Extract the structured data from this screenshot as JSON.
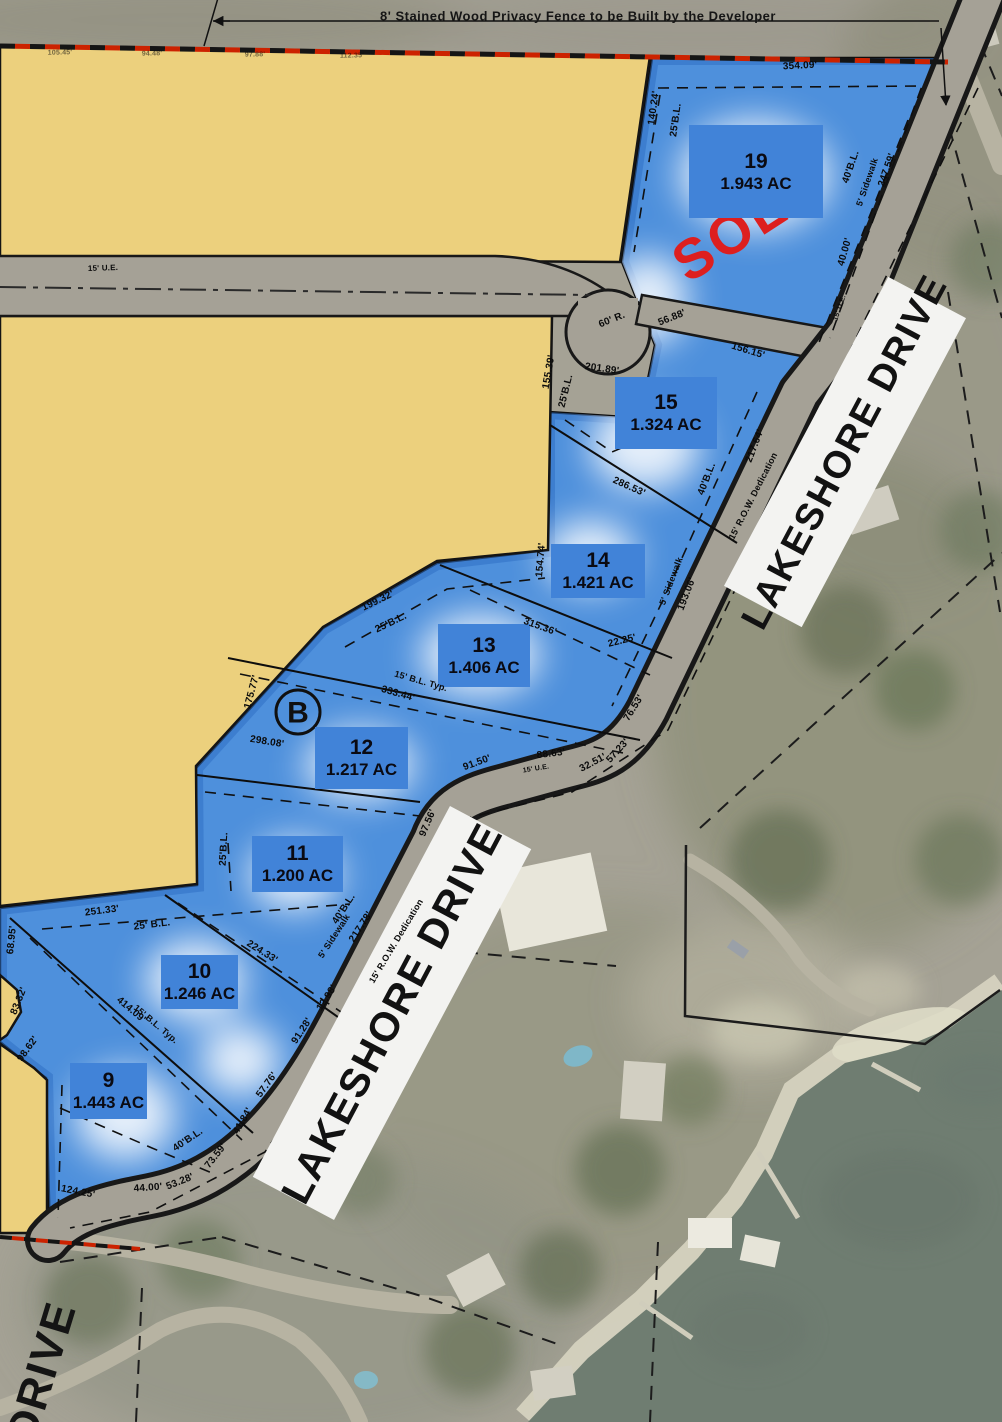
{
  "map_title": "Lakeshore Drive lakefront lot plat",
  "fence_note": "8' Stained Wood Privacy Fence to be Built by the Developer",
  "sold_stamp": "SOLD",
  "block_label": "B",
  "street_bands": [
    {
      "label": "LAKESHORE DRIVE"
    },
    {
      "label": "LAKESHORE DRIVE"
    }
  ],
  "partial_street_label": "DRIVE",
  "colors": {
    "lot_fill_blue": "#4e90dc",
    "lot_label_box_blue": "#4183d8",
    "parcel_yellow": "#ecd07d",
    "road_gray": "#a5a196",
    "sold_red": "#dd1f1f",
    "fence_dash_red": "#cc2200",
    "water_green": "#6f7d71",
    "band_white": "#f3f3f1"
  },
  "lots": [
    {
      "number": "19",
      "area": "1.943 AC",
      "sold": true,
      "x": 689,
      "y": 125,
      "w": 134,
      "h": 93
    },
    {
      "number": "15",
      "area": "1.324 AC",
      "sold": false,
      "x": 615,
      "y": 377,
      "w": 102,
      "h": 72
    },
    {
      "number": "14",
      "area": "1.421 AC",
      "sold": false,
      "x": 551,
      "y": 544,
      "w": 94,
      "h": 54
    },
    {
      "number": "13",
      "area": "1.406 AC",
      "sold": false,
      "x": 438,
      "y": 624,
      "w": 92,
      "h": 63
    },
    {
      "number": "12",
      "area": "1.217 AC",
      "sold": false,
      "x": 315,
      "y": 727,
      "w": 93,
      "h": 62
    },
    {
      "number": "11",
      "area": "1.200 AC",
      "sold": false,
      "x": 252,
      "y": 836,
      "w": 91,
      "h": 56
    },
    {
      "number": "10",
      "area": "1.246 AC",
      "sold": false,
      "x": 161,
      "y": 955,
      "w": 77,
      "h": 54
    },
    {
      "number": "9",
      "area": "1.443 AC",
      "sold": false,
      "x": 70,
      "y": 1063,
      "w": 77,
      "h": 56
    }
  ],
  "dimensions": [
    {
      "t": "354.09'",
      "x": 800,
      "y": 66,
      "r": -3
    },
    {
      "t": "140.24'",
      "x": 654,
      "y": 108,
      "r": -82
    },
    {
      "t": "25'B.L.",
      "x": 676,
      "y": 120,
      "r": -82
    },
    {
      "t": "40'B.L.",
      "x": 851,
      "y": 167,
      "r": -71
    },
    {
      "t": "5' Sidewalk",
      "x": 867,
      "y": 182,
      "r": -71,
      "s": 9
    },
    {
      "t": "247.59'",
      "x": 887,
      "y": 170,
      "r": -71
    },
    {
      "t": "40.00'",
      "x": 845,
      "y": 252,
      "r": -74
    },
    {
      "t": "15' U.E.",
      "x": 840,
      "y": 308,
      "r": -71,
      "s": 7
    },
    {
      "t": "56.88'",
      "x": 672,
      "y": 318,
      "r": -22
    },
    {
      "t": "60' R.",
      "x": 612,
      "y": 320,
      "r": -22
    },
    {
      "t": "201.89'",
      "x": 602,
      "y": 369,
      "r": 8
    },
    {
      "t": "155.39'",
      "x": 549,
      "y": 372,
      "r": -80
    },
    {
      "t": "25'B.L.",
      "x": 566,
      "y": 391,
      "r": -76
    },
    {
      "t": "156.15'",
      "x": 748,
      "y": 351,
      "r": 17
    },
    {
      "t": "217.64'",
      "x": 755,
      "y": 446,
      "r": -69
    },
    {
      "t": "40'B.L.",
      "x": 707,
      "y": 479,
      "r": -69
    },
    {
      "t": "286.53'",
      "x": 629,
      "y": 487,
      "r": 24
    },
    {
      "t": "154.74'",
      "x": 541,
      "y": 560,
      "r": -85
    },
    {
      "t": "15' R.O.W. Dedication",
      "x": 753,
      "y": 496,
      "r": -63,
      "s": 9
    },
    {
      "t": "5' Sidewalk",
      "x": 671,
      "y": 581,
      "r": -69,
      "s": 9
    },
    {
      "t": "193.06'",
      "x": 687,
      "y": 594,
      "r": -69
    },
    {
      "t": "315.36'",
      "x": 540,
      "y": 627,
      "r": 20
    },
    {
      "t": "22.25'",
      "x": 622,
      "y": 641,
      "r": -14
    },
    {
      "t": "199.32'",
      "x": 378,
      "y": 601,
      "r": -26
    },
    {
      "t": "25'B.L.",
      "x": 391,
      "y": 623,
      "r": -26
    },
    {
      "t": "15' B.L. Typ.",
      "x": 421,
      "y": 681,
      "r": 16,
      "s": 9
    },
    {
      "t": "333.44'",
      "x": 398,
      "y": 694,
      "r": 16
    },
    {
      "t": "175.77'",
      "x": 252,
      "y": 692,
      "r": -75
    },
    {
      "t": "76.53'",
      "x": 634,
      "y": 708,
      "r": -58
    },
    {
      "t": "57.23'",
      "x": 618,
      "y": 751,
      "r": -48
    },
    {
      "t": "32.51'",
      "x": 593,
      "y": 763,
      "r": -28
    },
    {
      "t": "88.63'",
      "x": 551,
      "y": 754,
      "r": -7
    },
    {
      "t": "15' U.E.",
      "x": 536,
      "y": 769,
      "r": -9,
      "s": 7
    },
    {
      "t": "91.50'",
      "x": 477,
      "y": 763,
      "r": -20
    },
    {
      "t": "97.56'",
      "x": 428,
      "y": 823,
      "r": -67
    },
    {
      "t": "298.08'",
      "x": 267,
      "y": 742,
      "r": 9
    },
    {
      "t": "25'B.L.",
      "x": 224,
      "y": 849,
      "r": -87
    },
    {
      "t": "40'B.L.",
      "x": 344,
      "y": 909,
      "r": -57
    },
    {
      "t": "5' Sidewalk",
      "x": 334,
      "y": 936,
      "r": -57,
      "s": 9
    },
    {
      "t": "217.78'",
      "x": 361,
      "y": 927,
      "r": -57
    },
    {
      "t": "15' R.O.W. Dedication",
      "x": 396,
      "y": 941,
      "r": -59,
      "s": 9
    },
    {
      "t": "224.33'",
      "x": 262,
      "y": 952,
      "r": 32
    },
    {
      "t": "12.98'",
      "x": 327,
      "y": 998,
      "r": -57
    },
    {
      "t": "91.28'",
      "x": 302,
      "y": 1031,
      "r": -57
    },
    {
      "t": "251.33'",
      "x": 102,
      "y": 911,
      "r": -7
    },
    {
      "t": "25' B.L.",
      "x": 152,
      "y": 925,
      "r": -7
    },
    {
      "t": "68.95'",
      "x": 12,
      "y": 940,
      "r": -84
    },
    {
      "t": "83.32'",
      "x": 19,
      "y": 1001,
      "r": -68
    },
    {
      "t": "98.62'",
      "x": 28,
      "y": 1049,
      "r": -54
    },
    {
      "t": "414.09'",
      "x": 131,
      "y": 1010,
      "r": 40
    },
    {
      "t": "15' B.L. Typ.",
      "x": 156,
      "y": 1024,
      "r": 40,
      "s": 9
    },
    {
      "t": "57.76'",
      "x": 267,
      "y": 1085,
      "r": -54
    },
    {
      "t": "41.84'",
      "x": 243,
      "y": 1121,
      "r": -60
    },
    {
      "t": "40'B.L.",
      "x": 188,
      "y": 1140,
      "r": -34
    },
    {
      "t": "73.59'",
      "x": 216,
      "y": 1156,
      "r": -52
    },
    {
      "t": "53.28'",
      "x": 180,
      "y": 1182,
      "r": -22
    },
    {
      "t": "44.00'",
      "x": 148,
      "y": 1188,
      "r": -4
    },
    {
      "t": "124.25'",
      "x": 78,
      "y": 1192,
      "r": 11
    },
    {
      "t": "15' U.E.",
      "x": 103,
      "y": 268,
      "r": -2,
      "s": 8
    },
    {
      "t": "105.45'",
      "x": 60,
      "y": 53,
      "r": -1,
      "s": 7,
      "o": 0.55
    },
    {
      "t": "94.48'",
      "x": 152,
      "y": 54,
      "r": -1,
      "s": 7,
      "o": 0.55
    },
    {
      "t": "97.88'",
      "x": 255,
      "y": 55,
      "r": -1,
      "s": 7,
      "o": 0.55
    },
    {
      "t": "112.35'",
      "x": 352,
      "y": 56,
      "r": -1,
      "s": 7,
      "o": 0.55
    }
  ]
}
